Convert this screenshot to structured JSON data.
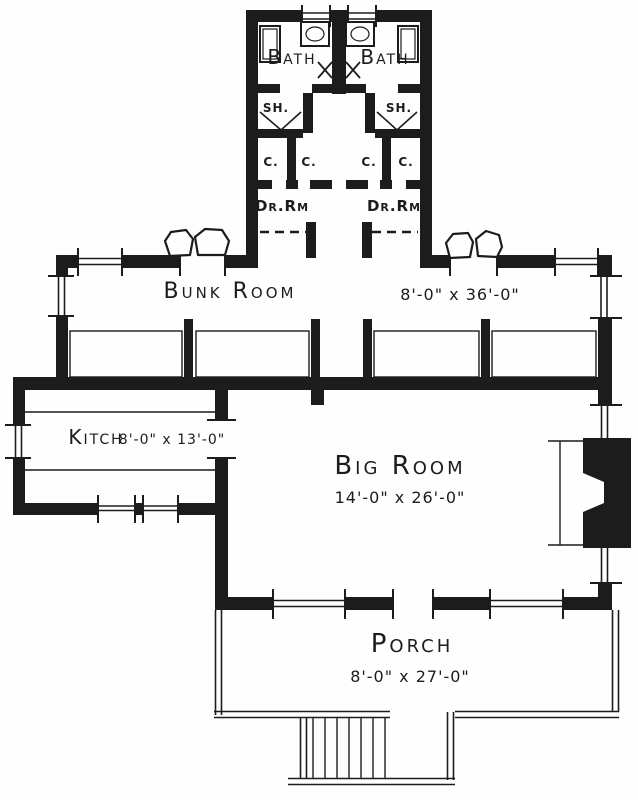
{
  "plan": {
    "ink_color": "#1c1c1c",
    "paper_color": "#fefefe",
    "rooms": {
      "baths": [
        {
          "label": "Bath"
        },
        {
          "label": "Bath"
        }
      ],
      "showers": [
        {
          "label": "SH."
        },
        {
          "label": "SH."
        }
      ],
      "closets": [
        {
          "label": "C."
        },
        {
          "label": "C."
        },
        {
          "label": "C."
        },
        {
          "label": "C."
        }
      ],
      "dressing_rooms": [
        {
          "label": "Dr.Rm"
        },
        {
          "label": "Dr.Rm"
        }
      ],
      "bunk_room": {
        "label": "Bunk Room",
        "dimensions": "8'-0\" x 36'-0\""
      },
      "kitchen": {
        "label": "Kitch",
        "dimensions": "8'-0\" x 13'-0\""
      },
      "big_room": {
        "label": "Big Room",
        "dimensions": "14'-0\" x 26'-0\""
      },
      "porch": {
        "label": "Porch",
        "dimensions": "8'-0\" x 27'-0\""
      }
    }
  }
}
